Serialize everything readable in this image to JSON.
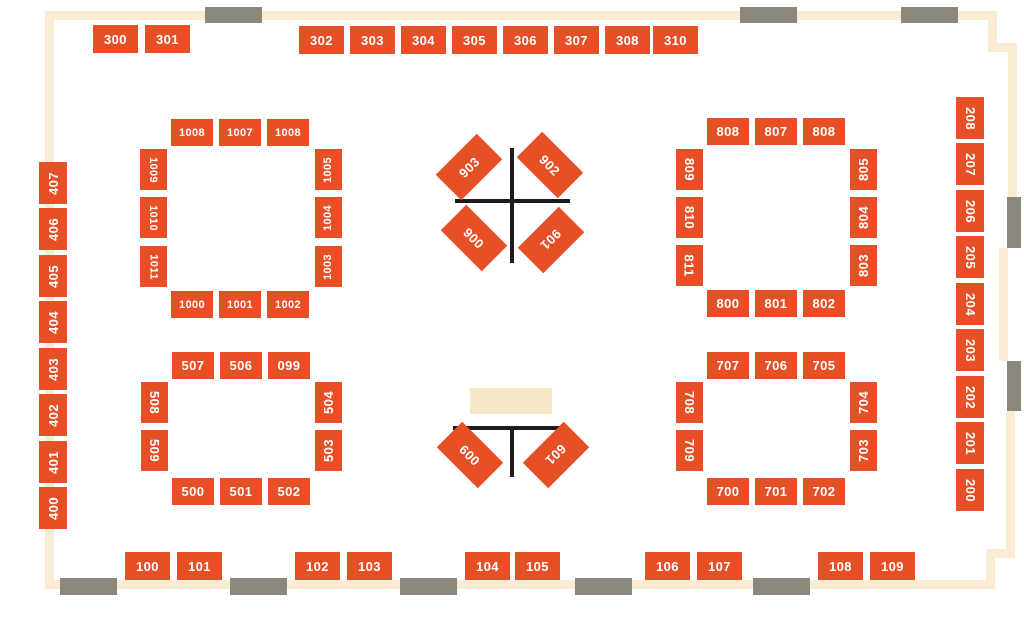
{
  "title": "Exhibit hall booth floor plan",
  "colors": {
    "booth": "#E74F27",
    "booth_text": "#FFFFFF",
    "wall": "#FAECD2",
    "door": "#8C877B",
    "line": "#1C1C1C",
    "stage": "#F8E7C6",
    "background": "#FFFFFF"
  },
  "walls": [
    {
      "x": 45,
      "y": 11,
      "w": 948,
      "h": 9
    },
    {
      "x": 45,
      "y": 11,
      "w": 9,
      "h": 578
    },
    {
      "x": 45,
      "y": 580,
      "w": 950,
      "h": 9
    },
    {
      "x": 988,
      "y": 11,
      "w": 9,
      "h": 41
    },
    {
      "x": 988,
      "y": 43,
      "w": 29,
      "h": 9
    },
    {
      "x": 1008,
      "y": 43,
      "w": 9,
      "h": 154
    },
    {
      "x": 999,
      "y": 248,
      "w": 9,
      "h": 113
    },
    {
      "x": 1006,
      "y": 411,
      "w": 9,
      "h": 140
    },
    {
      "x": 986,
      "y": 549,
      "w": 29,
      "h": 9
    },
    {
      "x": 986,
      "y": 549,
      "w": 9,
      "h": 40
    }
  ],
  "doors": [
    {
      "x": 205,
      "y": 7,
      "w": 57,
      "h": 16
    },
    {
      "x": 740,
      "y": 7,
      "w": 57,
      "h": 16
    },
    {
      "x": 901,
      "y": 7,
      "w": 57,
      "h": 16
    },
    {
      "x": 60,
      "y": 578,
      "w": 57,
      "h": 17
    },
    {
      "x": 230,
      "y": 578,
      "w": 57,
      "h": 17
    },
    {
      "x": 400,
      "y": 578,
      "w": 57,
      "h": 17
    },
    {
      "x": 575,
      "y": 578,
      "w": 57,
      "h": 17
    },
    {
      "x": 753,
      "y": 578,
      "w": 57,
      "h": 17
    },
    {
      "x": 1007,
      "y": 197,
      "w": 14,
      "h": 51
    },
    {
      "x": 1007,
      "y": 361,
      "w": 14,
      "h": 50
    }
  ],
  "lines": [
    {
      "x": 510,
      "y": 148,
      "w": 4,
      "h": 115
    },
    {
      "x": 455,
      "y": 199,
      "w": 115,
      "h": 4
    },
    {
      "x": 453,
      "y": 426,
      "w": 115,
      "h": 4
    },
    {
      "x": 510,
      "y": 426,
      "w": 4,
      "h": 51
    }
  ],
  "stage": {
    "x": 470,
    "y": 388,
    "w": 82,
    "h": 26
  },
  "booths": [
    {
      "l": "300",
      "x": 93,
      "y": 25,
      "w": 45,
      "h": 28,
      "r": 0,
      "t": 0
    },
    {
      "l": "301",
      "x": 145,
      "y": 25,
      "w": 45,
      "h": 28,
      "r": 0,
      "t": 0
    },
    {
      "l": "302",
      "x": 299,
      "y": 26,
      "w": 45,
      "h": 28,
      "r": 0,
      "t": 0
    },
    {
      "l": "303",
      "x": 350,
      "y": 26,
      "w": 45,
      "h": 28,
      "r": 0,
      "t": 0
    },
    {
      "l": "304",
      "x": 401,
      "y": 26,
      "w": 45,
      "h": 28,
      "r": 0,
      "t": 0
    },
    {
      "l": "305",
      "x": 452,
      "y": 26,
      "w": 45,
      "h": 28,
      "r": 0,
      "t": 0
    },
    {
      "l": "306",
      "x": 503,
      "y": 26,
      "w": 45,
      "h": 28,
      "r": 0,
      "t": 0
    },
    {
      "l": "307",
      "x": 554,
      "y": 26,
      "w": 45,
      "h": 28,
      "r": 0,
      "t": 0
    },
    {
      "l": "308",
      "x": 605,
      "y": 26,
      "w": 45,
      "h": 28,
      "r": 0,
      "t": 0
    },
    {
      "l": "310",
      "x": 653,
      "y": 26,
      "w": 45,
      "h": 28,
      "r": 0,
      "t": 0
    },
    {
      "l": "407",
      "x": 39,
      "y": 162,
      "w": 28,
      "h": 42,
      "r": 0,
      "t": -90
    },
    {
      "l": "406",
      "x": 39,
      "y": 208,
      "w": 28,
      "h": 42,
      "r": 0,
      "t": -90
    },
    {
      "l": "405",
      "x": 39,
      "y": 255,
      "w": 28,
      "h": 42,
      "r": 0,
      "t": -90
    },
    {
      "l": "404",
      "x": 39,
      "y": 301,
      "w": 28,
      "h": 42,
      "r": 0,
      "t": -90
    },
    {
      "l": "403",
      "x": 39,
      "y": 348,
      "w": 28,
      "h": 42,
      "r": 0,
      "t": -90
    },
    {
      "l": "402",
      "x": 39,
      "y": 394,
      "w": 28,
      "h": 42,
      "r": 0,
      "t": -90
    },
    {
      "l": "401",
      "x": 39,
      "y": 441,
      "w": 28,
      "h": 42,
      "r": 0,
      "t": -90
    },
    {
      "l": "400",
      "x": 39,
      "y": 487,
      "w": 28,
      "h": 42,
      "r": 0,
      "t": -90
    },
    {
      "l": "208",
      "x": 956,
      "y": 97,
      "w": 28,
      "h": 42,
      "r": 0,
      "t": 90
    },
    {
      "l": "207",
      "x": 956,
      "y": 143,
      "w": 28,
      "h": 42,
      "r": 0,
      "t": 90
    },
    {
      "l": "206",
      "x": 956,
      "y": 190,
      "w": 28,
      "h": 42,
      "r": 0,
      "t": 90
    },
    {
      "l": "205",
      "x": 956,
      "y": 236,
      "w": 28,
      "h": 42,
      "r": 0,
      "t": 90
    },
    {
      "l": "204",
      "x": 956,
      "y": 283,
      "w": 28,
      "h": 42,
      "r": 0,
      "t": 90
    },
    {
      "l": "203",
      "x": 956,
      "y": 329,
      "w": 28,
      "h": 42,
      "r": 0,
      "t": 90
    },
    {
      "l": "202",
      "x": 956,
      "y": 376,
      "w": 28,
      "h": 42,
      "r": 0,
      "t": 90
    },
    {
      "l": "201",
      "x": 956,
      "y": 422,
      "w": 28,
      "h": 42,
      "r": 0,
      "t": 90
    },
    {
      "l": "200",
      "x": 956,
      "y": 469,
      "w": 28,
      "h": 42,
      "r": 0,
      "t": 90
    },
    {
      "l": "100",
      "x": 125,
      "y": 552,
      "w": 45,
      "h": 28,
      "r": 0,
      "t": 0
    },
    {
      "l": "101",
      "x": 177,
      "y": 552,
      "w": 45,
      "h": 28,
      "r": 0,
      "t": 0
    },
    {
      "l": "102",
      "x": 295,
      "y": 552,
      "w": 45,
      "h": 28,
      "r": 0,
      "t": 0
    },
    {
      "l": "103",
      "x": 347,
      "y": 552,
      "w": 45,
      "h": 28,
      "r": 0,
      "t": 0
    },
    {
      "l": "104",
      "x": 465,
      "y": 552,
      "w": 45,
      "h": 28,
      "r": 0,
      "t": 0
    },
    {
      "l": "105",
      "x": 515,
      "y": 552,
      "w": 45,
      "h": 28,
      "r": 0,
      "t": 0
    },
    {
      "l": "106",
      "x": 645,
      "y": 552,
      "w": 45,
      "h": 28,
      "r": 0,
      "t": 0
    },
    {
      "l": "107",
      "x": 697,
      "y": 552,
      "w": 45,
      "h": 28,
      "r": 0,
      "t": 0
    },
    {
      "l": "108",
      "x": 818,
      "y": 552,
      "w": 45,
      "h": 28,
      "r": 0,
      "t": 0
    },
    {
      "l": "109",
      "x": 870,
      "y": 552,
      "w": 45,
      "h": 28,
      "r": 0,
      "t": 0
    },
    {
      "l": "1008",
      "x": 171,
      "y": 119,
      "w": 42,
      "h": 27,
      "r": 0,
      "t": 0
    },
    {
      "l": "1007",
      "x": 219,
      "y": 119,
      "w": 42,
      "h": 27,
      "r": 0,
      "t": 0
    },
    {
      "l": "1008",
      "x": 267,
      "y": 119,
      "w": 42,
      "h": 27,
      "r": 0,
      "t": 0
    },
    {
      "l": "1009",
      "x": 140,
      "y": 149,
      "w": 27,
      "h": 41,
      "r": 0,
      "t": 90
    },
    {
      "l": "1010",
      "x": 140,
      "y": 197,
      "w": 27,
      "h": 41,
      "r": 0,
      "t": 90
    },
    {
      "l": "1011",
      "x": 140,
      "y": 246,
      "w": 27,
      "h": 41,
      "r": 0,
      "t": 90
    },
    {
      "l": "1005",
      "x": 315,
      "y": 149,
      "w": 27,
      "h": 41,
      "r": 0,
      "t": -90
    },
    {
      "l": "1004",
      "x": 315,
      "y": 197,
      "w": 27,
      "h": 41,
      "r": 0,
      "t": -90
    },
    {
      "l": "1003",
      "x": 315,
      "y": 246,
      "w": 27,
      "h": 41,
      "r": 0,
      "t": -90
    },
    {
      "l": "1000",
      "x": 171,
      "y": 291,
      "w": 42,
      "h": 27,
      "r": 0,
      "t": 0
    },
    {
      "l": "1001",
      "x": 219,
      "y": 291,
      "w": 42,
      "h": 27,
      "r": 0,
      "t": 0
    },
    {
      "l": "1002",
      "x": 267,
      "y": 291,
      "w": 42,
      "h": 27,
      "r": 0,
      "t": 0
    },
    {
      "l": "808",
      "x": 707,
      "y": 118,
      "w": 42,
      "h": 27,
      "r": 0,
      "t": 0
    },
    {
      "l": "807",
      "x": 755,
      "y": 118,
      "w": 42,
      "h": 27,
      "r": 0,
      "t": 0
    },
    {
      "l": "808",
      "x": 803,
      "y": 118,
      "w": 42,
      "h": 27,
      "r": 0,
      "t": 0
    },
    {
      "l": "809",
      "x": 676,
      "y": 149,
      "w": 27,
      "h": 41,
      "r": 0,
      "t": 90
    },
    {
      "l": "810",
      "x": 676,
      "y": 197,
      "w": 27,
      "h": 41,
      "r": 0,
      "t": 90
    },
    {
      "l": "811",
      "x": 676,
      "y": 245,
      "w": 27,
      "h": 41,
      "r": 0,
      "t": 90
    },
    {
      "l": "805",
      "x": 850,
      "y": 149,
      "w": 27,
      "h": 41,
      "r": 0,
      "t": -90
    },
    {
      "l": "804",
      "x": 850,
      "y": 197,
      "w": 27,
      "h": 41,
      "r": 0,
      "t": -90
    },
    {
      "l": "803",
      "x": 850,
      "y": 245,
      "w": 27,
      "h": 41,
      "r": 0,
      "t": -90
    },
    {
      "l": "800",
      "x": 707,
      "y": 290,
      "w": 42,
      "h": 27,
      "r": 0,
      "t": 0
    },
    {
      "l": "801",
      "x": 755,
      "y": 290,
      "w": 42,
      "h": 27,
      "r": 0,
      "t": 0
    },
    {
      "l": "802",
      "x": 803,
      "y": 290,
      "w": 42,
      "h": 27,
      "r": 0,
      "t": 0
    },
    {
      "l": "507",
      "x": 172,
      "y": 352,
      "w": 42,
      "h": 27,
      "r": 0,
      "t": 0
    },
    {
      "l": "506",
      "x": 220,
      "y": 352,
      "w": 42,
      "h": 27,
      "r": 0,
      "t": 0
    },
    {
      "l": "099",
      "x": 268,
      "y": 352,
      "w": 42,
      "h": 27,
      "r": 0,
      "t": 0
    },
    {
      "l": "508",
      "x": 141,
      "y": 382,
      "w": 27,
      "h": 41,
      "r": 0,
      "t": 90
    },
    {
      "l": "509",
      "x": 141,
      "y": 430,
      "w": 27,
      "h": 41,
      "r": 0,
      "t": 90
    },
    {
      "l": "504",
      "x": 315,
      "y": 382,
      "w": 27,
      "h": 41,
      "r": 0,
      "t": -90
    },
    {
      "l": "503",
      "x": 315,
      "y": 430,
      "w": 27,
      "h": 41,
      "r": 0,
      "t": -90
    },
    {
      "l": "500",
      "x": 172,
      "y": 478,
      "w": 42,
      "h": 27,
      "r": 0,
      "t": 0
    },
    {
      "l": "501",
      "x": 220,
      "y": 478,
      "w": 42,
      "h": 27,
      "r": 0,
      "t": 0
    },
    {
      "l": "502",
      "x": 268,
      "y": 478,
      "w": 42,
      "h": 27,
      "r": 0,
      "t": 0
    },
    {
      "l": "707",
      "x": 707,
      "y": 352,
      "w": 42,
      "h": 27,
      "r": 0,
      "t": 0
    },
    {
      "l": "706",
      "x": 755,
      "y": 352,
      "w": 42,
      "h": 27,
      "r": 0,
      "t": 0
    },
    {
      "l": "705",
      "x": 803,
      "y": 352,
      "w": 42,
      "h": 27,
      "r": 0,
      "t": 0
    },
    {
      "l": "708",
      "x": 676,
      "y": 382,
      "w": 27,
      "h": 41,
      "r": 0,
      "t": 90
    },
    {
      "l": "709",
      "x": 676,
      "y": 430,
      "w": 27,
      "h": 41,
      "r": 0,
      "t": 90
    },
    {
      "l": "704",
      "x": 850,
      "y": 382,
      "w": 27,
      "h": 41,
      "r": 0,
      "t": -90
    },
    {
      "l": "703",
      "x": 850,
      "y": 430,
      "w": 27,
      "h": 41,
      "r": 0,
      "t": -90
    },
    {
      "l": "700",
      "x": 707,
      "y": 478,
      "w": 42,
      "h": 27,
      "r": 0,
      "t": 0
    },
    {
      "l": "701",
      "x": 755,
      "y": 478,
      "w": 42,
      "h": 27,
      "r": 0,
      "t": 0
    },
    {
      "l": "702",
      "x": 803,
      "y": 478,
      "w": 42,
      "h": 27,
      "r": 0,
      "t": 0
    },
    {
      "l": "903",
      "x": 440,
      "y": 149,
      "w": 58,
      "h": 36,
      "r": -45,
      "t": 0
    },
    {
      "l": "902",
      "x": 521,
      "y": 147,
      "w": 58,
      "h": 36,
      "r": 45,
      "t": 0
    },
    {
      "l": "900",
      "x": 445,
      "y": 220,
      "w": 58,
      "h": 36,
      "r": 45,
      "t": 0
    },
    {
      "l": "901",
      "x": 522,
      "y": 222,
      "w": 58,
      "h": 36,
      "r": 135,
      "t": 0
    },
    {
      "l": "600",
      "x": 441,
      "y": 437,
      "w": 58,
      "h": 36,
      "r": 45,
      "t": 0
    },
    {
      "l": "601",
      "x": 527,
      "y": 437,
      "w": 58,
      "h": 36,
      "r": 135,
      "t": 0
    }
  ]
}
